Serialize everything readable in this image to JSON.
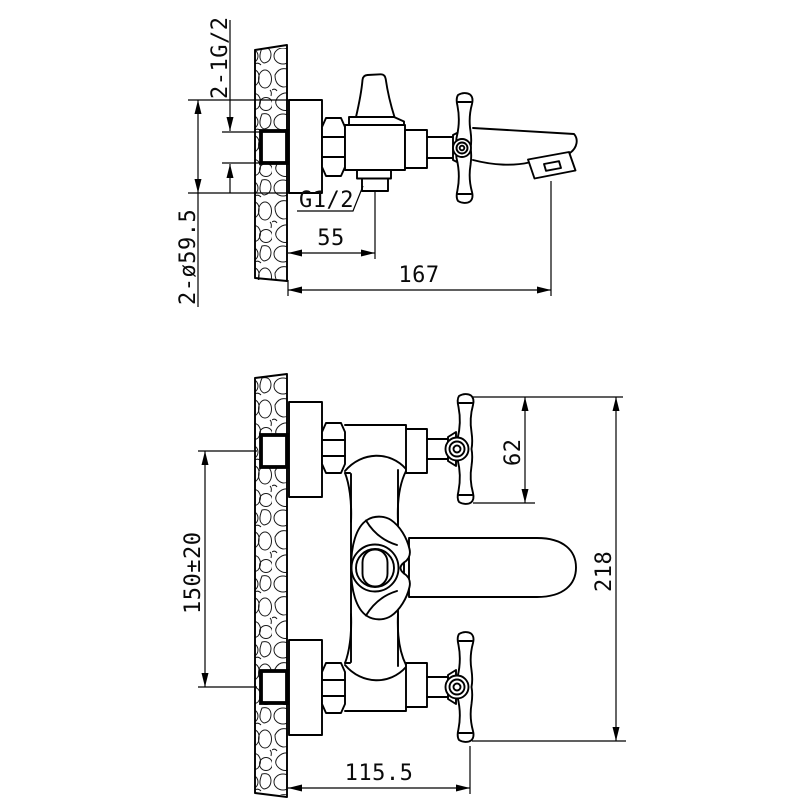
{
  "page": {
    "background": "#ffffff",
    "ink_color": "#000000",
    "drawing_subject": "wall-mounted bath mixer faucet dimensional drawing"
  },
  "side_view": {
    "labels": {
      "inlet_thread": "2-1G/2",
      "flange_diameter": "2-ø59.5",
      "outlet_thread": "G1/2",
      "outlet_offset": "55",
      "spout_reach": "167"
    }
  },
  "front_view": {
    "labels": {
      "handle_height": "62",
      "inlet_spacing": "150±20",
      "overall_height": "218",
      "handle_reach": "115.5"
    }
  }
}
